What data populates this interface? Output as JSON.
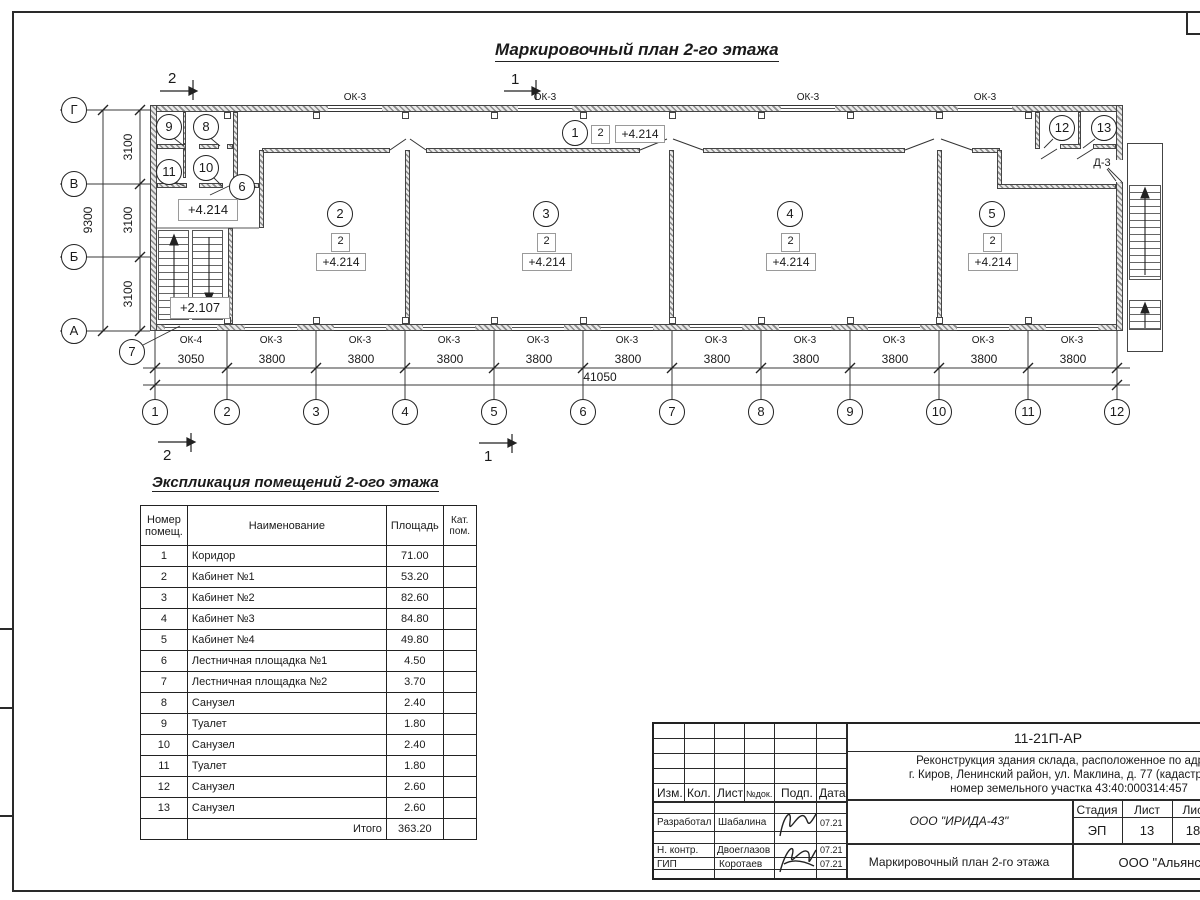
{
  "sheet": {
    "title": "Маркировочный план 2-го этажа"
  },
  "plan": {
    "grid_columns": [
      "1",
      "2",
      "3",
      "4",
      "5",
      "6",
      "7",
      "8",
      "9",
      "10",
      "11",
      "12"
    ],
    "grid_rows": [
      "Г",
      "В",
      "Б",
      "А"
    ],
    "dims_h": [
      "3050",
      "3800",
      "3800",
      "3800",
      "3800",
      "3800",
      "3800",
      "3800",
      "3800",
      "3800",
      "3800"
    ],
    "dim_total_h": "41050",
    "dims_v": [
      "3100",
      "3100",
      "3100"
    ],
    "dim_total_v": "9300",
    "section_markers": {
      "top_left": "2",
      "top_mid": "1",
      "bottom_left": "2",
      "bottom_mid": "1"
    },
    "windows_top": [
      "ОК-3",
      "ОК-3",
      "ОК-3",
      "ОК-3"
    ],
    "windows_bottom": [
      "ОК-4",
      "ОК-3",
      "ОК-3",
      "ОК-3",
      "ОК-3",
      "ОК-3",
      "ОК-3",
      "ОК-3",
      "ОК-3",
      "ОК-3",
      "ОК-3"
    ],
    "door_label": "Д-3",
    "levels": {
      "landing": "+4.214",
      "stair": "+2.107"
    },
    "rooms": [
      {
        "num": "1",
        "cat": "2",
        "level": "+4.214"
      },
      {
        "num": "2",
        "cat": "2",
        "level": "+4.214"
      },
      {
        "num": "3",
        "cat": "2",
        "level": "+4.214"
      },
      {
        "num": "4",
        "cat": "2",
        "level": "+4.214"
      },
      {
        "num": "5",
        "cat": "2",
        "level": "+4.214"
      },
      {
        "num": "6"
      },
      {
        "num": "7"
      },
      {
        "num": "8"
      },
      {
        "num": "9"
      },
      {
        "num": "10"
      },
      {
        "num": "11"
      },
      {
        "num": "12"
      },
      {
        "num": "13"
      }
    ]
  },
  "table": {
    "title": "Экспликация помещений 2-ого этажа",
    "headers": {
      "num": "Номер помещ.",
      "name": "Наименование",
      "area": "Площадь",
      "cat": "Кат. пом."
    },
    "rows": [
      {
        "num": "1",
        "name": "Коридор",
        "area": "71.00"
      },
      {
        "num": "2",
        "name": "Кабинет №1",
        "area": "53.20"
      },
      {
        "num": "3",
        "name": "Кабинет №2",
        "area": "82.60"
      },
      {
        "num": "4",
        "name": "Кабинет №3",
        "area": "84.80"
      },
      {
        "num": "5",
        "name": "Кабинет №4",
        "area": "49.80"
      },
      {
        "num": "6",
        "name": "Лестничная площадка №1",
        "area": "4.50"
      },
      {
        "num": "7",
        "name": "Лестничная площадка №2",
        "area": "3.70"
      },
      {
        "num": "8",
        "name": "Санузел",
        "area": "2.40"
      },
      {
        "num": "9",
        "name": "Туалет",
        "area": "1.80"
      },
      {
        "num": "10",
        "name": "Санузел",
        "area": "2.40"
      },
      {
        "num": "11",
        "name": "Туалет",
        "area": "1.80"
      },
      {
        "num": "12",
        "name": "Санузел",
        "area": "2.60"
      },
      {
        "num": "13",
        "name": "Санузел",
        "area": "2.60"
      }
    ],
    "total_label": "Итого",
    "total_value": "363.20"
  },
  "titleblock": {
    "code": "11-21П-АР",
    "project_line1": "Реконструкция здания склада, расположенное по адресу",
    "project_line2": "г. Киров, Ленинский район, ул. Маклина, д. 77 (кадастровый",
    "project_line3": "номер земельного участка 43:40:000314:457",
    "org": "ООО \"ИРИДА-43\"",
    "doc_title": "Маркировочный план 2-го этажа",
    "company": "ООО \"Альянс\"",
    "stage_headers": [
      "Стадия",
      "Лист",
      "Листов"
    ],
    "stage_values": [
      "ЭП",
      "13",
      "18"
    ],
    "col_labels": [
      "Изм.",
      "Кол.",
      "Лист",
      "№док.",
      "Подп.",
      "Дата"
    ],
    "people": [
      {
        "role": "Разработал",
        "name": "Шабалина",
        "date": "07.21"
      },
      {
        "role": "Н. контр.",
        "name": "Двоеглазов",
        "date": "07.21"
      },
      {
        "role": "ГИП",
        "name": "Коротаев",
        "date": "07.21"
      }
    ]
  }
}
